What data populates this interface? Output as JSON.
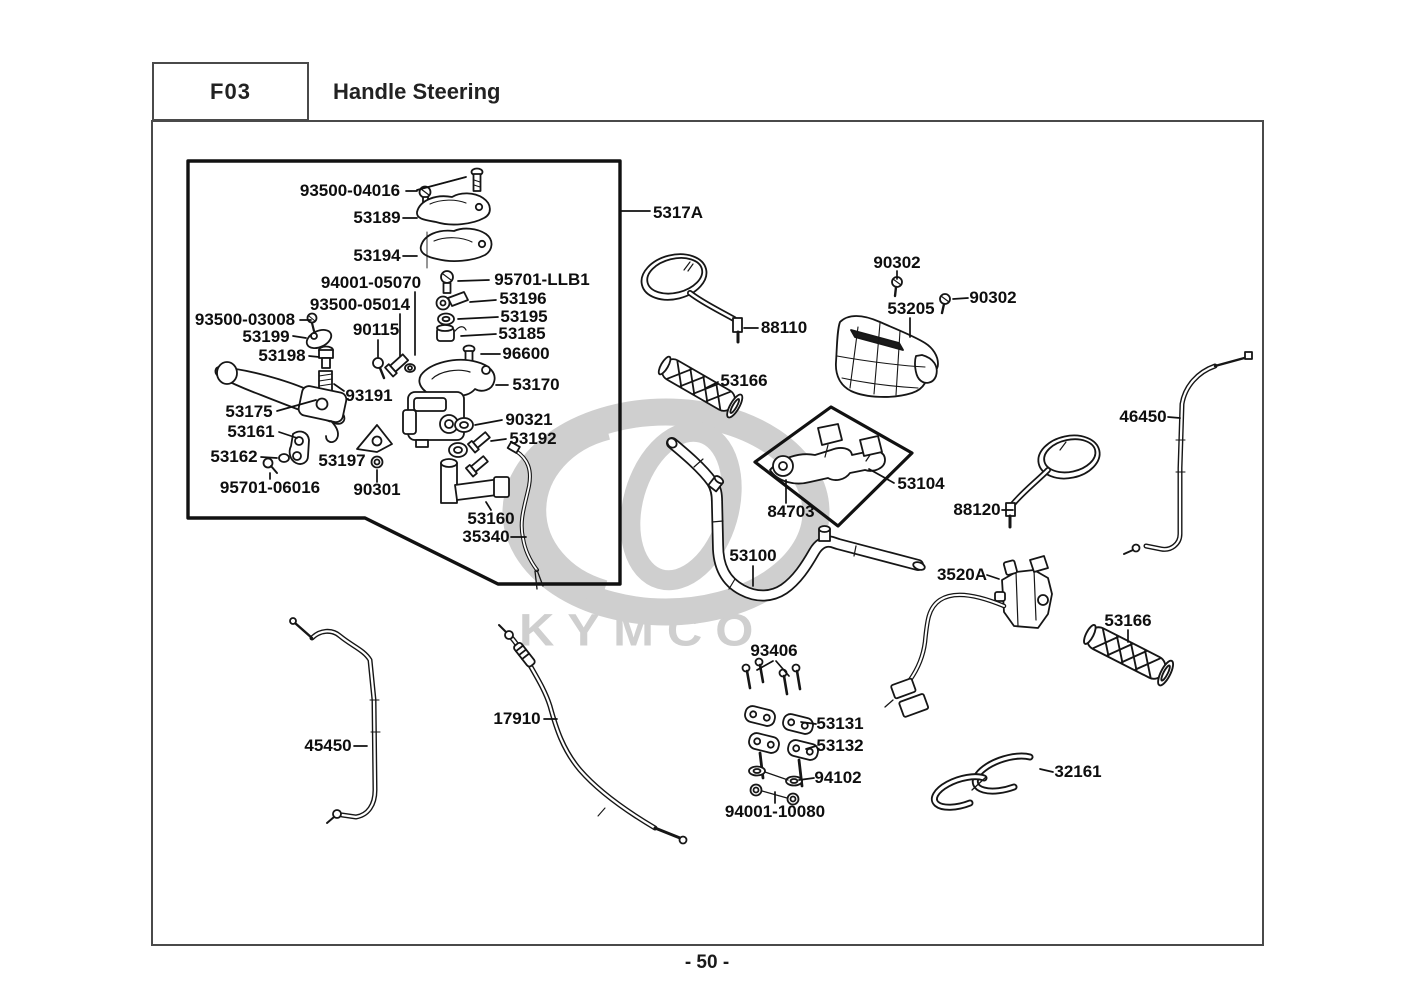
{
  "header": {
    "code": "F03",
    "title": "Handle Steering"
  },
  "footer": {
    "page_label": "- 50 -"
  },
  "watermark": {
    "brand": "KYMCO",
    "color": "#cfcfcf"
  },
  "diagram": {
    "line_color": "#161616",
    "parts": [
      {
        "id": "p93500-04016",
        "label": "93500-04016",
        "x": 350,
        "y": 191
      },
      {
        "id": "p53189",
        "label": "53189",
        "x": 377,
        "y": 218
      },
      {
        "id": "p53194",
        "label": "53194",
        "x": 377,
        "y": 256
      },
      {
        "id": "p94001-05070",
        "label": "94001-05070",
        "x": 371,
        "y": 283
      },
      {
        "id": "p95701-LLB1",
        "label": "95701-LLB1",
        "x": 542,
        "y": 280
      },
      {
        "id": "p93500-05014",
        "label": "93500-05014",
        "x": 360,
        "y": 305
      },
      {
        "id": "p53196",
        "label": "53196",
        "x": 523,
        "y": 299
      },
      {
        "id": "p93500-03008",
        "label": "93500-03008",
        "x": 245,
        "y": 320
      },
      {
        "id": "p53195",
        "label": "53195",
        "x": 524,
        "y": 317
      },
      {
        "id": "p53199",
        "label": "53199",
        "x": 266,
        "y": 337
      },
      {
        "id": "p90115",
        "label": "90115",
        "x": 376,
        "y": 330
      },
      {
        "id": "p53185",
        "label": "53185",
        "x": 522,
        "y": 334
      },
      {
        "id": "p53198",
        "label": "53198",
        "x": 282,
        "y": 356
      },
      {
        "id": "p96600",
        "label": "96600",
        "x": 526,
        "y": 354
      },
      {
        "id": "p53170",
        "label": "53170",
        "x": 536,
        "y": 385
      },
      {
        "id": "p93191",
        "label": "93191",
        "x": 369,
        "y": 396
      },
      {
        "id": "p53175",
        "label": "53175",
        "x": 249,
        "y": 412
      },
      {
        "id": "p90321",
        "label": "90321",
        "x": 529,
        "y": 420
      },
      {
        "id": "p53161",
        "label": "53161",
        "x": 251,
        "y": 432
      },
      {
        "id": "p53192",
        "label": "53192",
        "x": 533,
        "y": 439
      },
      {
        "id": "p53162",
        "label": "53162",
        "x": 234,
        "y": 457
      },
      {
        "id": "p53197",
        "label": "53197",
        "x": 342,
        "y": 461
      },
      {
        "id": "p95701-06016",
        "label": "95701-06016",
        "x": 270,
        "y": 488
      },
      {
        "id": "p90301",
        "label": "90301",
        "x": 377,
        "y": 490
      },
      {
        "id": "p53160",
        "label": "53160",
        "x": 491,
        "y": 519
      },
      {
        "id": "p35340",
        "label": "35340",
        "x": 486,
        "y": 537
      },
      {
        "id": "p5317A",
        "label": "5317A",
        "x": 678,
        "y": 213
      },
      {
        "id": "p88110",
        "label": "88110",
        "x": 784,
        "y": 328
      },
      {
        "id": "p90302-top",
        "label": "90302",
        "x": 897,
        "y": 263
      },
      {
        "id": "p53205",
        "label": "53205",
        "x": 911,
        "y": 309
      },
      {
        "id": "p90302-right",
        "label": "90302",
        "x": 993,
        "y": 298
      },
      {
        "id": "p53166-left",
        "label": "53166",
        "x": 744,
        "y": 381
      },
      {
        "id": "p46450",
        "label": "46450",
        "x": 1143,
        "y": 417
      },
      {
        "id": "p53104",
        "label": "53104",
        "x": 921,
        "y": 484
      },
      {
        "id": "p84703",
        "label": "84703",
        "x": 791,
        "y": 512
      },
      {
        "id": "p88120",
        "label": "88120",
        "x": 977,
        "y": 510
      },
      {
        "id": "p53100",
        "label": "53100",
        "x": 753,
        "y": 556
      },
      {
        "id": "p3520A",
        "label": "3520A",
        "x": 962,
        "y": 575
      },
      {
        "id": "p53166-right",
        "label": "53166",
        "x": 1128,
        "y": 621
      },
      {
        "id": "p93406",
        "label": "93406",
        "x": 774,
        "y": 651
      },
      {
        "id": "p17910",
        "label": "17910",
        "x": 517,
        "y": 719
      },
      {
        "id": "p53131",
        "label": "53131",
        "x": 840,
        "y": 724
      },
      {
        "id": "p53132",
        "label": "53132",
        "x": 840,
        "y": 746
      },
      {
        "id": "p45450",
        "label": "45450",
        "x": 328,
        "y": 746
      },
      {
        "id": "p94102",
        "label": "94102",
        "x": 838,
        "y": 778
      },
      {
        "id": "p94001-10080",
        "label": "94001-10080",
        "x": 775,
        "y": 812
      },
      {
        "id": "p32161",
        "label": "32161",
        "x": 1078,
        "y": 772
      }
    ]
  }
}
